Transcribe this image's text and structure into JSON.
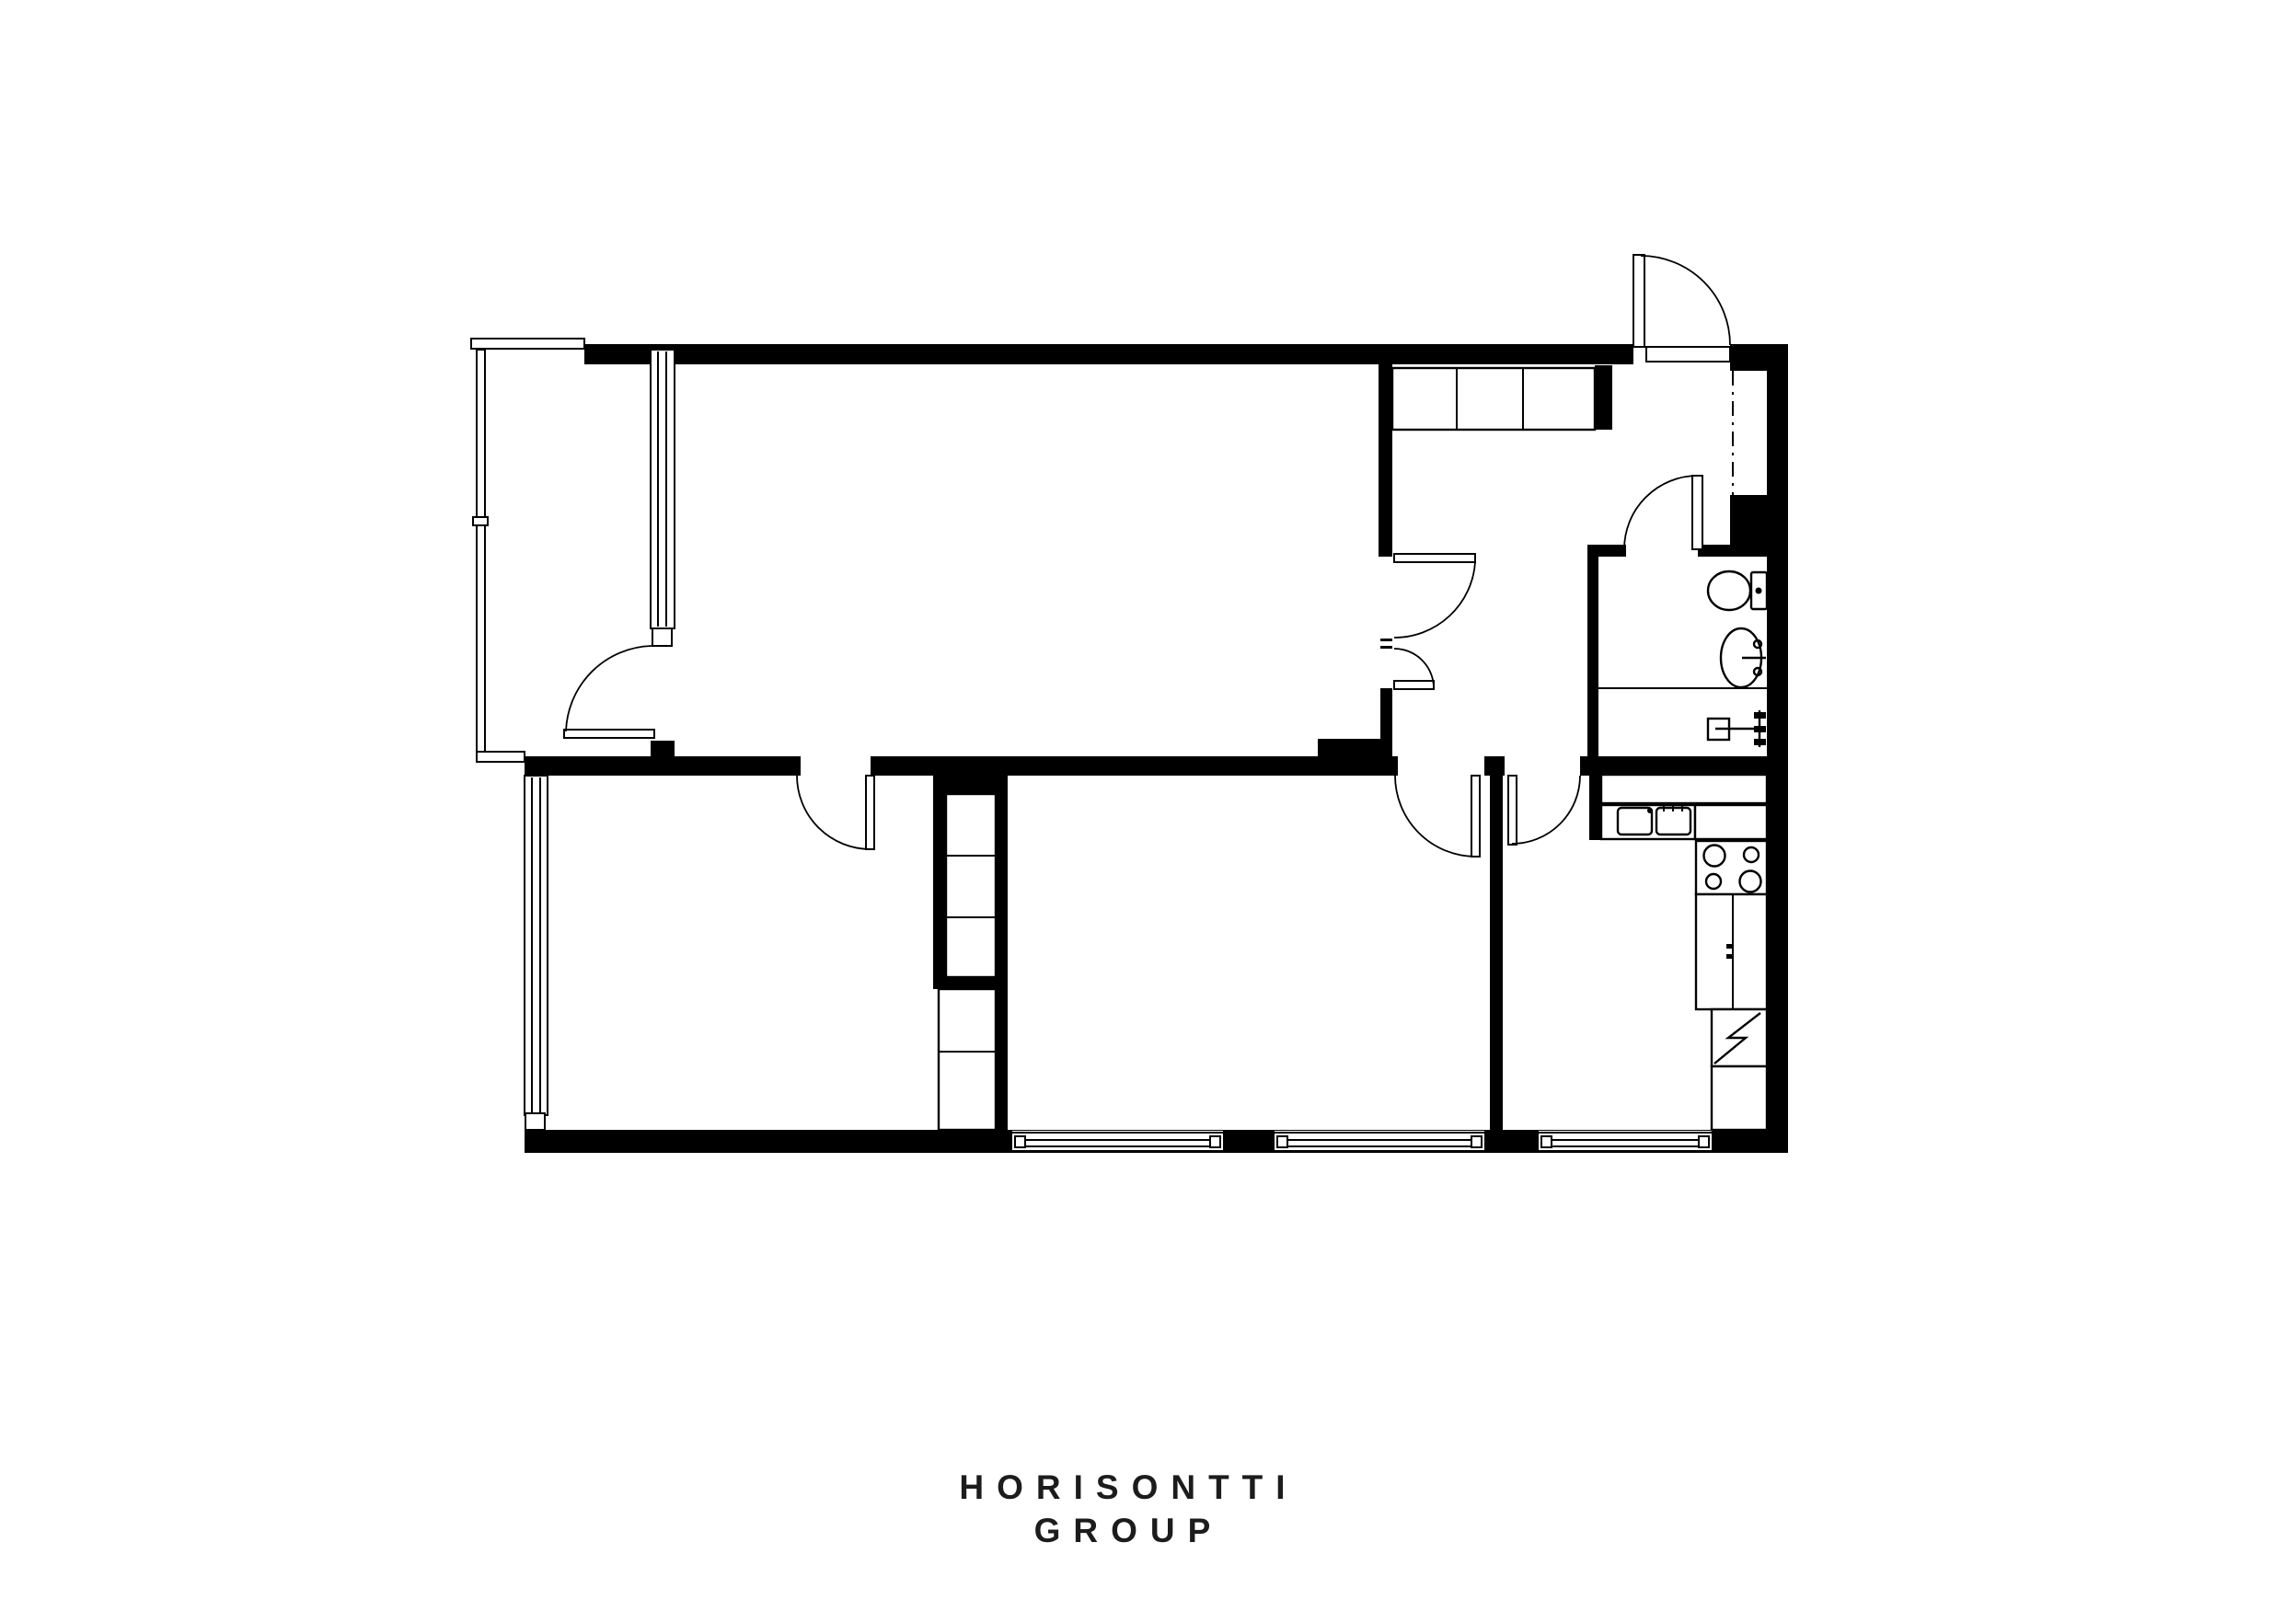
{
  "branding": {
    "line1": "HORISONTTI",
    "line2": "GROUP"
  },
  "palette": {
    "background": "#ffffff",
    "ink": "#000000",
    "text": "#1c1c1c"
  },
  "plan": {
    "type": "apartment-floor-plan",
    "rooms_visible": 7,
    "door_swings": 8,
    "bottom_wall_windows": 3,
    "fixture_icons": [
      "entrance-door-icon",
      "balcony-railing-icon",
      "balcony-door-icon",
      "hall-wardrobe-icon",
      "bedroom-wardrobe-icon",
      "toilet-icon",
      "washbasin-icon",
      "shower-valve-icon",
      "kitchen-counter-icon",
      "double-basin-sink-icon",
      "four-burner-stove-icon",
      "base-cabinet-icon",
      "refrigerator-icon",
      "window-icon"
    ]
  }
}
